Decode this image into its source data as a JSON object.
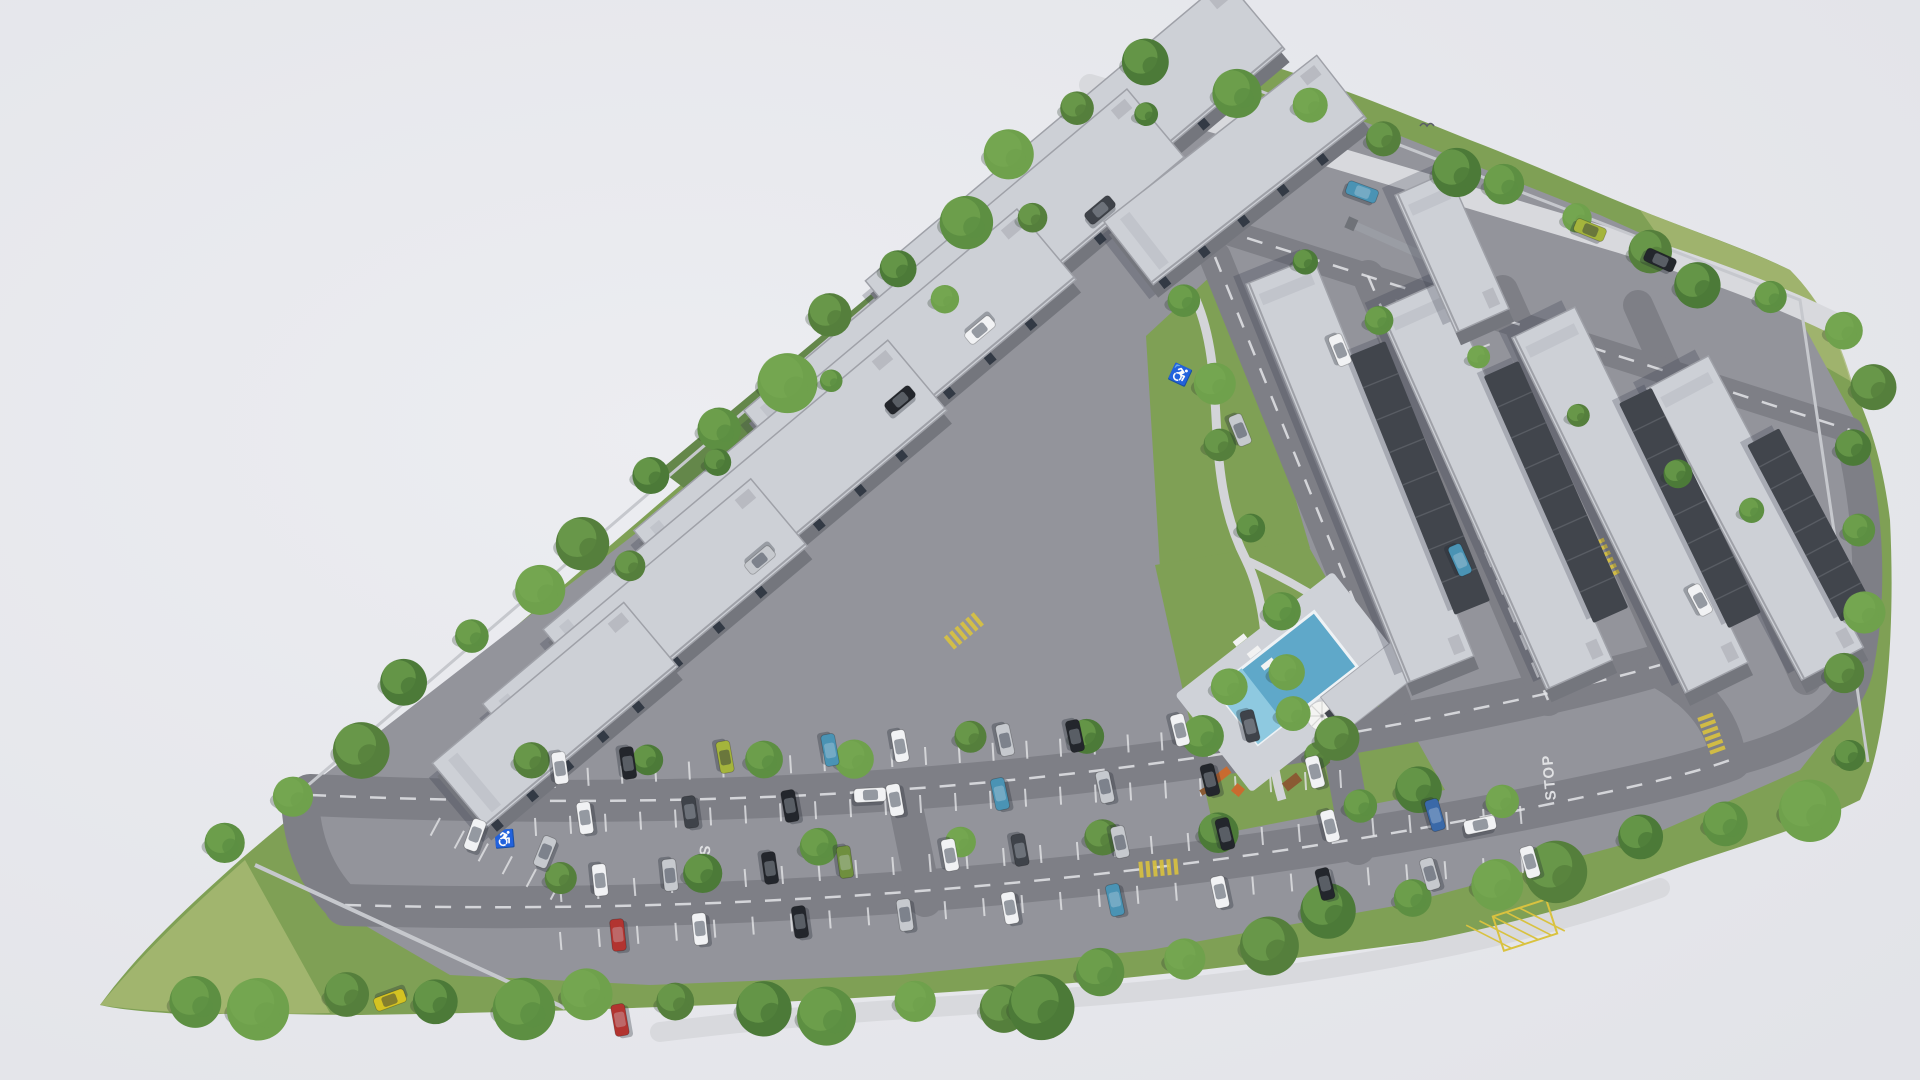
{
  "scene": {
    "type": "aerial-3d-architectural-render",
    "description": "Aerial 3D rendering of a gated residential apartment complex on a roughly triangular landscaped site with internal roads, surface parking full of cars, perimeter trees and a central courtyard with swimming pool, umbrella, playground and picnic tables.",
    "counts": {
      "apartment_blocks": 12,
      "carport_rows": 4,
      "swimming_pools": 1,
      "stop_markings": 2
    }
  },
  "palette": {
    "sky": "#e9eaee",
    "sky_edge": "#e2e3e8",
    "grass": "#7fa055",
    "grass_dark": "#64874a",
    "grass_light": "#a7b873",
    "asphalt": "#93949b",
    "asphalt_light": "#d8d9dd",
    "asphalt_dark": "#7e7f86",
    "roof_light": "#cdd0d6",
    "roof_edge": "#9fa1a8",
    "wall_dark": "#74767d",
    "window": "#333a45",
    "carport": "#41454c",
    "carport_rib": "#585c63",
    "pool_water": "#5fa8c9",
    "pool_water_light": "#8ec9e0",
    "pool_deck": "#cfd2d8",
    "path": "#d3d4d8",
    "line_white": "#e3e4e7",
    "line_yellow": "#d9c23f",
    "wall_perimeter": "#c6c8cd",
    "shadow": "rgba(45,52,65,0.24)",
    "tree_tones": [
      "#4c7a38",
      "#5d8f42",
      "#6fa14c",
      "#557f3c"
    ],
    "tree_highlight": "#79ab54",
    "umbrella": "#f4f4f2",
    "wood": "#8a5a33",
    "play_orange": "#c96b2f",
    "bird": "#5a5d66"
  },
  "markings": {
    "stop1": "STOP",
    "stop2": "STOP",
    "handicap_symbol": "♿",
    "bumps": [
      [
        1160,
        868,
        -5
      ],
      [
        1605,
        560,
        65
      ],
      [
        1712,
        735,
        70
      ],
      [
        965,
        630,
        -40
      ]
    ],
    "crosswalks": [
      [
        1295,
        150,
        20
      ]
    ],
    "hatch_box": [
      1525,
      925,
      -18,
      56,
      36
    ],
    "handicaps": [
      [
        505,
        845,
        -5
      ],
      [
        1178,
        380,
        25
      ]
    ]
  },
  "roads": [
    {
      "name": "main-road-upper",
      "d": "M310,795 C700,812 1000,792 1310,740 C1450,716 1580,688 1660,665",
      "w": 42
    },
    {
      "name": "main-road-lower",
      "d": "M345,905 C800,918 1200,872 1520,810 C1620,790 1690,775 1730,760",
      "w": 42
    },
    {
      "name": "connector-left",
      "d": "M300,798 Q302,862 342,903",
      "w": 38
    },
    {
      "name": "connector-right",
      "d": "M1655,668 Q1718,700 1728,756",
      "w": 36
    },
    {
      "name": "connector-mid-1",
      "d": "M905,802 L925,900",
      "w": 34
    },
    {
      "name": "connector-mid-2",
      "d": "M1338,737 L1358,848",
      "w": 34
    },
    {
      "name": "left-lane-1",
      "d": "M805,405 L1190,82",
      "w": 34
    },
    {
      "name": "left-lane-2",
      "d": "M593,636 L1007,288",
      "w": 34
    },
    {
      "name": "left-lane-3",
      "d": "M454,792 L746,548",
      "w": 32
    },
    {
      "name": "left-lane-connector",
      "d": "M593,636 Q565,705 545,778",
      "w": 30
    },
    {
      "name": "right-lane-1",
      "d": "M1215,257 L1395,702",
      "w": 32
    },
    {
      "name": "right-lane-2",
      "d": "M1368,276 L1548,700",
      "w": 32
    },
    {
      "name": "right-lane-3",
      "d": "M1503,290 L1683,690",
      "w": 30
    },
    {
      "name": "right-lane-4",
      "d": "M1638,305 L1806,680",
      "w": 30
    },
    {
      "name": "top-right-road",
      "d": "M1190,220 Q1500,318 1850,430",
      "w": 26
    },
    {
      "name": "right-loop-road",
      "d": "M1850,435 Q1880,560 1858,670 Q1842,735 1730,762",
      "w": 30
    },
    {
      "name": "outer-street",
      "d": "M1090,85 Q1350,162 1620,242 Q1760,285 1852,332",
      "w": 22,
      "light": true
    }
  ],
  "dashed_roads": [
    "main-road-upper",
    "main-road-lower",
    "left-lane-1",
    "left-lane-2",
    "right-lane-1",
    "right-lane-2",
    "top-right-road"
  ],
  "stall_rows": [
    [
      520,
      772,
      1330,
      722,
      24,
      18
    ],
    [
      500,
      820,
      1340,
      770,
      24,
      18
    ],
    [
      560,
      884,
      1520,
      806,
      26,
      18
    ],
    [
      560,
      932,
      1560,
      852,
      26,
      18
    ],
    [
      440,
      818,
      560,
      882,
      5,
      20
    ],
    [
      880,
      360,
      1180,
      112,
      9,
      16
    ],
    [
      1478,
      315,
      1560,
      520,
      7,
      16
    ]
  ],
  "buildings": [
    {
      "n": "block-L1",
      "x": 1075,
      "y": 165,
      "l": 470,
      "w": 92,
      "a": -40,
      "k": "apt"
    },
    {
      "n": "block-L2",
      "x": 965,
      "y": 285,
      "l": 500,
      "w": 92,
      "a": -40,
      "k": "apt"
    },
    {
      "n": "block-L3",
      "x": 855,
      "y": 405,
      "l": 500,
      "w": 92,
      "a": -40,
      "k": "apt"
    },
    {
      "n": "block-L4",
      "x": 745,
      "y": 520,
      "l": 450,
      "w": 92,
      "a": -40,
      "k": "apt"
    },
    {
      "n": "block-L5",
      "x": 645,
      "y": 625,
      "l": 350,
      "w": 88,
      "a": -40,
      "k": "apt"
    },
    {
      "n": "block-L6",
      "x": 555,
      "y": 715,
      "l": 250,
      "w": 84,
      "a": -40,
      "k": "apt"
    },
    {
      "n": "block-top",
      "x": 1235,
      "y": 170,
      "l": 270,
      "w": 80,
      "a": -38,
      "k": "apt"
    },
    {
      "n": "block-R1",
      "x": 1360,
      "y": 470,
      "l": 430,
      "w": 72,
      "a": 68,
      "k": "apt"
    },
    {
      "n": "block-R2",
      "x": 1495,
      "y": 485,
      "l": 415,
      "w": 72,
      "a": 66,
      "k": "apt"
    },
    {
      "n": "block-R3",
      "x": 1630,
      "y": 500,
      "l": 395,
      "w": 70,
      "a": 64,
      "k": "apt"
    },
    {
      "n": "block-R4",
      "x": 1755,
      "y": 518,
      "l": 330,
      "w": 70,
      "a": 62,
      "k": "apt"
    },
    {
      "n": "gate-office",
      "x": 1452,
      "y": 252,
      "l": 150,
      "w": 58,
      "a": 66,
      "k": "apt"
    },
    {
      "n": "carport-1",
      "x": 1420,
      "y": 478,
      "l": 280,
      "w": 38,
      "a": 68,
      "k": "carport"
    },
    {
      "n": "carport-2",
      "x": 1556,
      "y": 492,
      "l": 270,
      "w": 38,
      "a": 66,
      "k": "carport"
    },
    {
      "n": "carport-3",
      "x": 1690,
      "y": 508,
      "l": 250,
      "w": 36,
      "a": 64,
      "k": "carport"
    },
    {
      "n": "carport-4",
      "x": 1810,
      "y": 525,
      "l": 200,
      "w": 36,
      "a": 62,
      "k": "carport"
    }
  ],
  "tree_rows": [
    {
      "f": [
        230,
        850
      ],
      "t": [
        1140,
        60
      ],
      "n": 16,
      "r": [
        16,
        30
      ]
    },
    {
      "f": [
        1250,
        85
      ],
      "t": [
        1840,
        330
      ],
      "n": 10,
      "r": [
        14,
        26
      ]
    },
    {
      "f": [
        1862,
        380
      ],
      "t": [
        1852,
        760
      ],
      "n": 6,
      "r": [
        15,
        23
      ]
    },
    {
      "f": [
        190,
        1000
      ],
      "t": [
        1000,
        1008
      ],
      "n": 11,
      "r": [
        18,
        33
      ]
    },
    {
      "f": [
        1030,
        1000
      ],
      "t": [
        1800,
        805
      ],
      "n": 11,
      "r": [
        18,
        33
      ]
    },
    {
      "f": [
        540,
        770
      ],
      "t": [
        1300,
        722
      ],
      "n": 8,
      "r": [
        15,
        21
      ]
    },
    {
      "f": [
        560,
        880
      ],
      "t": [
        1500,
        802
      ],
      "n": 8,
      "r": [
        15,
        21
      ]
    },
    {
      "f": [
        620,
        560
      ],
      "t": [
        1150,
        120
      ],
      "n": 6,
      "r": [
        11,
        16
      ]
    },
    {
      "f": [
        1180,
        300
      ],
      "t": [
        1320,
        760
      ],
      "n": 7,
      "r": [
        13,
        21
      ]
    },
    {
      "f": [
        1300,
        260
      ],
      "t": [
        1760,
        520
      ],
      "n": 6,
      "r": [
        10,
        15
      ]
    },
    {
      "f": [
        1230,
        690
      ],
      "t": [
        1430,
        780
      ],
      "n": 3,
      "r": [
        18,
        25
      ]
    }
  ],
  "cars": [
    [
      560,
      768,
      82,
      "W"
    ],
    [
      628,
      763,
      82,
      "K"
    ],
    [
      725,
      757,
      80,
      "L"
    ],
    [
      830,
      750,
      80,
      "T"
    ],
    [
      900,
      746,
      80,
      "W"
    ],
    [
      1005,
      740,
      78,
      "S"
    ],
    [
      1075,
      736,
      78,
      "K"
    ],
    [
      1180,
      730,
      76,
      "W"
    ],
    [
      1250,
      726,
      76,
      "D"
    ],
    [
      585,
      818,
      262,
      "W"
    ],
    [
      690,
      812,
      262,
      "D"
    ],
    [
      790,
      806,
      260,
      "K"
    ],
    [
      895,
      800,
      260,
      "W"
    ],
    [
      1000,
      794,
      258,
      "T"
    ],
    [
      1105,
      787,
      258,
      "S"
    ],
    [
      1210,
      780,
      256,
      "K"
    ],
    [
      1315,
      772,
      256,
      "W"
    ],
    [
      600,
      880,
      84,
      "W"
    ],
    [
      670,
      875,
      84,
      "S"
    ],
    [
      770,
      868,
      82,
      "K"
    ],
    [
      845,
      862,
      82,
      "O"
    ],
    [
      950,
      855,
      80,
      "W"
    ],
    [
      1020,
      850,
      80,
      "D"
    ],
    [
      1120,
      842,
      78,
      "S"
    ],
    [
      1225,
      834,
      76,
      "K"
    ],
    [
      1330,
      826,
      76,
      "W"
    ],
    [
      1435,
      815,
      74,
      "B"
    ],
    [
      618,
      935,
      264,
      "R"
    ],
    [
      700,
      929,
      264,
      "W"
    ],
    [
      800,
      922,
      262,
      "K"
    ],
    [
      905,
      915,
      262,
      "S"
    ],
    [
      1010,
      908,
      260,
      "W"
    ],
    [
      1115,
      900,
      258,
      "T"
    ],
    [
      1220,
      892,
      258,
      "W"
    ],
    [
      1325,
      884,
      256,
      "K"
    ],
    [
      1430,
      874,
      254,
      "S"
    ],
    [
      1530,
      862,
      254,
      "W"
    ],
    [
      475,
      835,
      290,
      "W"
    ],
    [
      545,
      852,
      292,
      "S"
    ],
    [
      390,
      1000,
      160,
      "Y"
    ],
    [
      620,
      1020,
      260,
      "R"
    ],
    [
      1340,
      350,
      68,
      "W"
    ],
    [
      1460,
      560,
      66,
      "T"
    ],
    [
      1700,
      600,
      62,
      "W"
    ],
    [
      1240,
      430,
      68,
      "S"
    ],
    [
      980,
      330,
      140,
      "W"
    ],
    [
      900,
      400,
      -40,
      "K"
    ],
    [
      760,
      560,
      140,
      "S"
    ],
    [
      1100,
      210,
      -40,
      "D"
    ],
    [
      1362,
      192,
      20,
      "T"
    ],
    [
      1590,
      230,
      22,
      "L"
    ],
    [
      1660,
      260,
      24,
      "K"
    ],
    [
      870,
      795,
      -3,
      "W"
    ],
    [
      1480,
      825,
      -12,
      "W"
    ]
  ],
  "car_colors": {
    "W": "#f1f2f4",
    "S": "#c6c9ce",
    "G": "#7c8087",
    "K": "#23262c",
    "D": "#3f434a",
    "T": "#4a93b4",
    "B": "#3a69a8",
    "R": "#b23430",
    "Y": "#d4c322",
    "L": "#a4b43c",
    "O": "#6f8f3e"
  },
  "birds": [
    [
      1427,
      126
    ]
  ]
}
